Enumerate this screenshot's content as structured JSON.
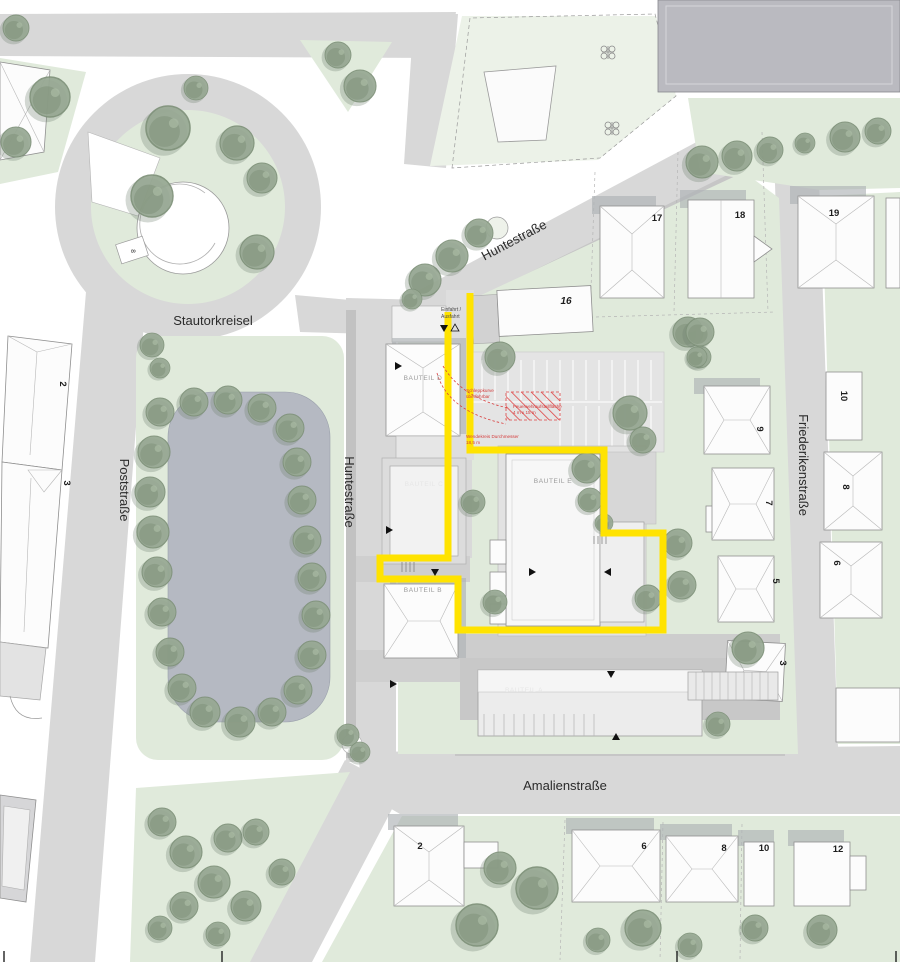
{
  "streets": {
    "stautorkreisel": "Stautorkreisel",
    "huntestrasse_top": "Huntestraße",
    "huntestrasse_west": "Huntestraße",
    "poststrasse": "Poststraße",
    "amalienstrasse": "Amalienstraße",
    "friederikenstrasse": "Friederikenstraße"
  },
  "buildings": {
    "bauteil_a": "BAUTEIL A",
    "bauteil_b": "BAUTEIL B",
    "bauteil_c": "BAUTEIL C",
    "bauteil_d": "BAUTEIL D",
    "bauteil_e": "BAUTEIL E"
  },
  "access": {
    "einfahrt_line1": "Einfahrt /",
    "einfahrt_line2": "Ausfahrt"
  },
  "fire_notes": {
    "schleppkurve_1": "Schleppkurve",
    "schleppkurve_2": "überfahrbar",
    "aufstellflaeche_1": "Feuerwehraufstellfläche",
    "aufstellflaeche_2": "4 m x 15 m",
    "wendekreis_1": "Wendekreis Durchmesser",
    "wendekreis_2": "18,5 m"
  },
  "house_numbers": {
    "top_16": "16",
    "top_17": "17",
    "top_18": "18",
    "top_19": "19",
    "fried_w_9": "9",
    "fried_w_7": "7",
    "fried_w_5": "5",
    "fried_w_3": "3",
    "fried_e_10": "10",
    "fried_e_8": "8",
    "fried_e_6": "6",
    "amalien_2": "2",
    "amalien_6": "6",
    "amalien_8": "8",
    "amalien_10": "10",
    "amalien_12": "12",
    "post_2": "2",
    "post_3": "3",
    "kreisel_8": "8"
  },
  "colors": {
    "route_yellow": "#ffe300",
    "annotation_red": "#d43b3b",
    "street_gray": "#d8d8d8",
    "green_area": "#e0eadb",
    "tree_green": "#97a893",
    "basin_gray": "#b5b9c2"
  }
}
